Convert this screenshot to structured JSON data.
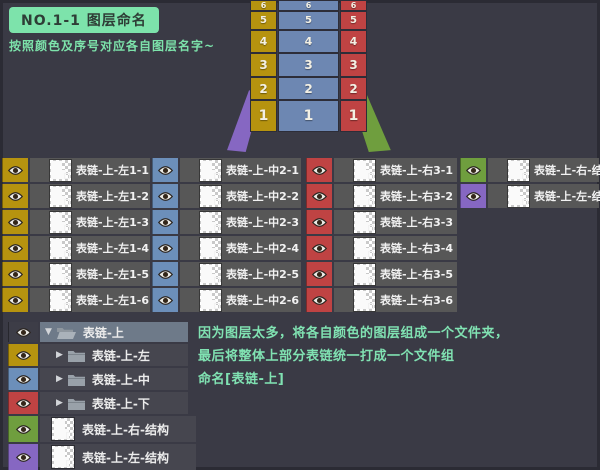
{
  "header": {
    "title": "NO.1-1 图层命名",
    "subtitle": "按照颜色及序号对应各自图层名字~"
  },
  "colors": {
    "background": "#3a3a45",
    "frame": "#2b2b34",
    "title_green_bg": "#7de3ab",
    "title_text": "#2e3d36",
    "note_green": "#80e2b2",
    "yellow": "#b6930f",
    "blue_diagram": "#6d87b2",
    "blue_eye": "#6c8fba",
    "red": "#bf4343",
    "green": "#6f9e3e",
    "purple": "#8667c2",
    "row_gray": "#575757",
    "tree_row_gray": "#46464f",
    "tree_selected": "#6e7a89",
    "tree_eye_neutral": "#3d3d47"
  },
  "diagram": {
    "left_numbers": [
      "6",
      "5",
      "4",
      "3",
      "2",
      "1"
    ],
    "center_numbers": [
      "6",
      "5",
      "4",
      "3",
      "2",
      "1"
    ],
    "right_numbers": [
      "6",
      "5",
      "4",
      "3",
      "2",
      "1"
    ]
  },
  "icons": {
    "expanded_triangle": "▼",
    "collapsed_triangle": "▶",
    "eye": "visibility-eye",
    "folder": "group-folder",
    "thumbnail": "layer-thumbnail"
  },
  "layer_groups": [
    {
      "name": "left-column",
      "eye_color": "#b6930f",
      "labels": [
        "表链-上-左1-1",
        "表链-上-左1-2",
        "表链-上-左1-3",
        "表链-上-左1-4",
        "表链-上-左1-5",
        "表链-上-左1-6"
      ]
    },
    {
      "name": "middle-column",
      "eye_color": "#6c8fba",
      "labels": [
        "表链-上-中2-1",
        "表链-上-中2-2",
        "表链-上-中2-3",
        "表链-上-中2-4",
        "表链-上-中2-5",
        "表链-上-中2-6"
      ]
    },
    {
      "name": "right-column",
      "eye_color": "#bf4343",
      "labels": [
        "表链-上-右3-1",
        "表链-上-右3-2",
        "表链-上-右3-3",
        "表链-上-右3-4",
        "表链-上-右3-5",
        "表链-上-右3-6"
      ]
    },
    {
      "name": "structure-column",
      "eye_colors": [
        "#6f9e3e",
        "#8667c2"
      ],
      "labels": [
        "表链-上-右-结构",
        "表链-上-左-结构"
      ]
    }
  ],
  "tree": {
    "rows": [
      {
        "kind": "group-expanded",
        "eye_color": "#3d3d47",
        "label": "表链-上",
        "selected": true
      },
      {
        "kind": "group-collapsed",
        "eye_color": "#b6930f",
        "label": "表链-上-左",
        "selected": false
      },
      {
        "kind": "group-collapsed",
        "eye_color": "#6c8fba",
        "label": "表链-上-中",
        "selected": false
      },
      {
        "kind": "group-collapsed",
        "eye_color": "#bf4343",
        "label": "表链-上-下",
        "selected": false
      },
      {
        "kind": "layer",
        "eye_color": "#6f9e3e",
        "label": "表链-上-右-结构",
        "selected": false
      },
      {
        "kind": "layer",
        "eye_color": "#8667c2",
        "label": "表链-上-左-结构",
        "selected": false
      }
    ]
  },
  "note": {
    "lines": [
      "因为图层太多，将各自颜色的图层组成一个文件夹，",
      "最后将整体上部分表链统一打成一个文件组",
      "命名[表链-上]"
    ]
  }
}
